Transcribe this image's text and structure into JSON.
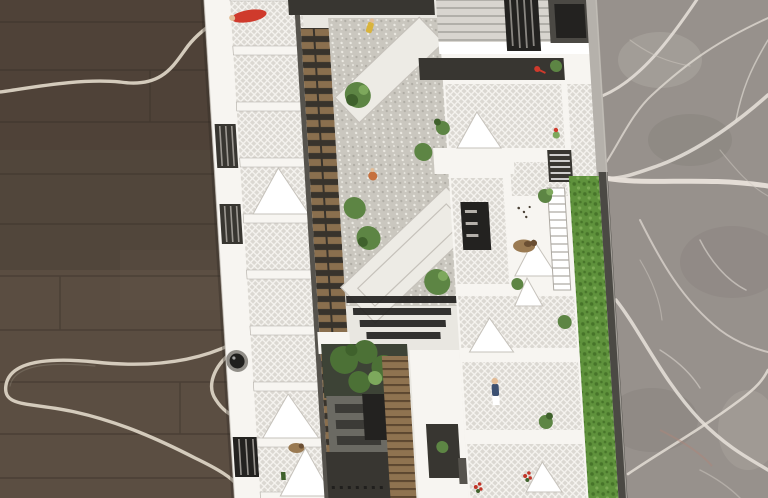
{
  "meta": {
    "title": "Top-down photograph of an architectural scale model",
    "media_type": "photograph",
    "width_px": 768,
    "height_px": 498
  },
  "scene": {
    "description": "A white architectural scale model of an apartment block with two landscaped courtyards, lattice-railed balconies, folded white awnings, a rooftop hedge strip, miniature figures and a teal toy car. The model sits on the boundary between a dark wood plank floor (left, with a pale charging cable snaking across it) and grey veined marble tiles (right).",
    "objects": [
      {
        "name": "wood-floor",
        "description": "dark brown wood plank flooring, left side"
      },
      {
        "name": "power-cable",
        "description": "pale beige cable looping across the wood floor"
      },
      {
        "name": "marble-floor",
        "description": "grey marble with white veins, right side"
      },
      {
        "name": "building-model",
        "description": "white cardboard/foam architectural model, slightly tilted"
      },
      {
        "name": "gravel-courtyard",
        "description": "upper courtyard with gravel, diagonal white walkways and bushes"
      },
      {
        "name": "garden-courtyard",
        "description": "lower courtyard with dark trees, grey deck and wooden stair"
      },
      {
        "name": "balcony-lattice",
        "description": "balconies covered with white diagonal mesh"
      },
      {
        "name": "rooftop-hedge",
        "description": "green hedge strip along right edge of model"
      },
      {
        "name": "miniature-car",
        "description": "teal toy car on striped drive at top"
      },
      {
        "name": "miniature-figures",
        "description": "tiny red, yellow, orange and blue human figures, a brown dog and a parrot"
      },
      {
        "name": "black-knob",
        "description": "small black cylindrical knob on left edge of the model"
      }
    ]
  },
  "colors": {
    "wood_base": "#55493e",
    "wood_dark": "#453a30",
    "wood_light": "#6a5b4b",
    "plank_line": "#372f27",
    "floor_shadow": "#2f2821",
    "marble_base": "#97918c",
    "marble_dark": "#7e7973",
    "marble_light": "#b5afa8",
    "vein": "#e8e2da",
    "vein_soft": "#cfc9c1",
    "marble_blush": "#b08578",
    "cable": "#d4cbbc",
    "cable_shadow": "#8f8679",
    "model_white": "#e9e7e1",
    "model_bright": "#f7f5f1",
    "model_shadow": "#c6c2bb",
    "model_line": "#aeaaa3",
    "roof_dark": "#383631",
    "roof_mid": "#56534d",
    "roof_deep": "#232220",
    "mesh_bg": "#dbd8d2",
    "mesh_line": "#f6f4f0",
    "gravel": "#cac7bf",
    "gravel_dot_dark": "#adaaa2",
    "gravel_dot_light": "#edebe4",
    "path_white": "#edebe5",
    "slat_bg": "#38332c",
    "slat_wood": "#8a6f4e",
    "stair_wood": "#8f7350",
    "stair_line": "#5c4730",
    "plant_green": "#5d8544",
    "plant_dark": "#3f612c",
    "plant_light": "#7da85c",
    "hedge_green": "#5f923c",
    "hedge_dark": "#47742a",
    "hedge_light": "#7cab55",
    "tree_green": "#4c7136",
    "tree_bg": "#3d4336",
    "car_teal": "#84c6cb",
    "car_glass": "#2e3b3f",
    "fig_red": "#cf3a2c",
    "fig_yellow": "#d9b43c",
    "fig_orange": "#c6703d",
    "fig_blue": "#3c5071",
    "fig_skin": "#e3bd97",
    "dog_brown": "#9a7a52",
    "dog_patch": "#6b4f33",
    "knob_dark": "#201f1d",
    "knob_ring": "#908d87",
    "flower_red": "#c03427",
    "platform_grey": "#6b6a63",
    "platform_dark": "#3c3b37",
    "wall_dark": "#4b4944",
    "edge_grey": "#b5b1ab",
    "stripe_grey": "#a8a59f",
    "road_grey": "#d8d5cf",
    "white": "#ffffff",
    "dirt": "#4a4136"
  }
}
